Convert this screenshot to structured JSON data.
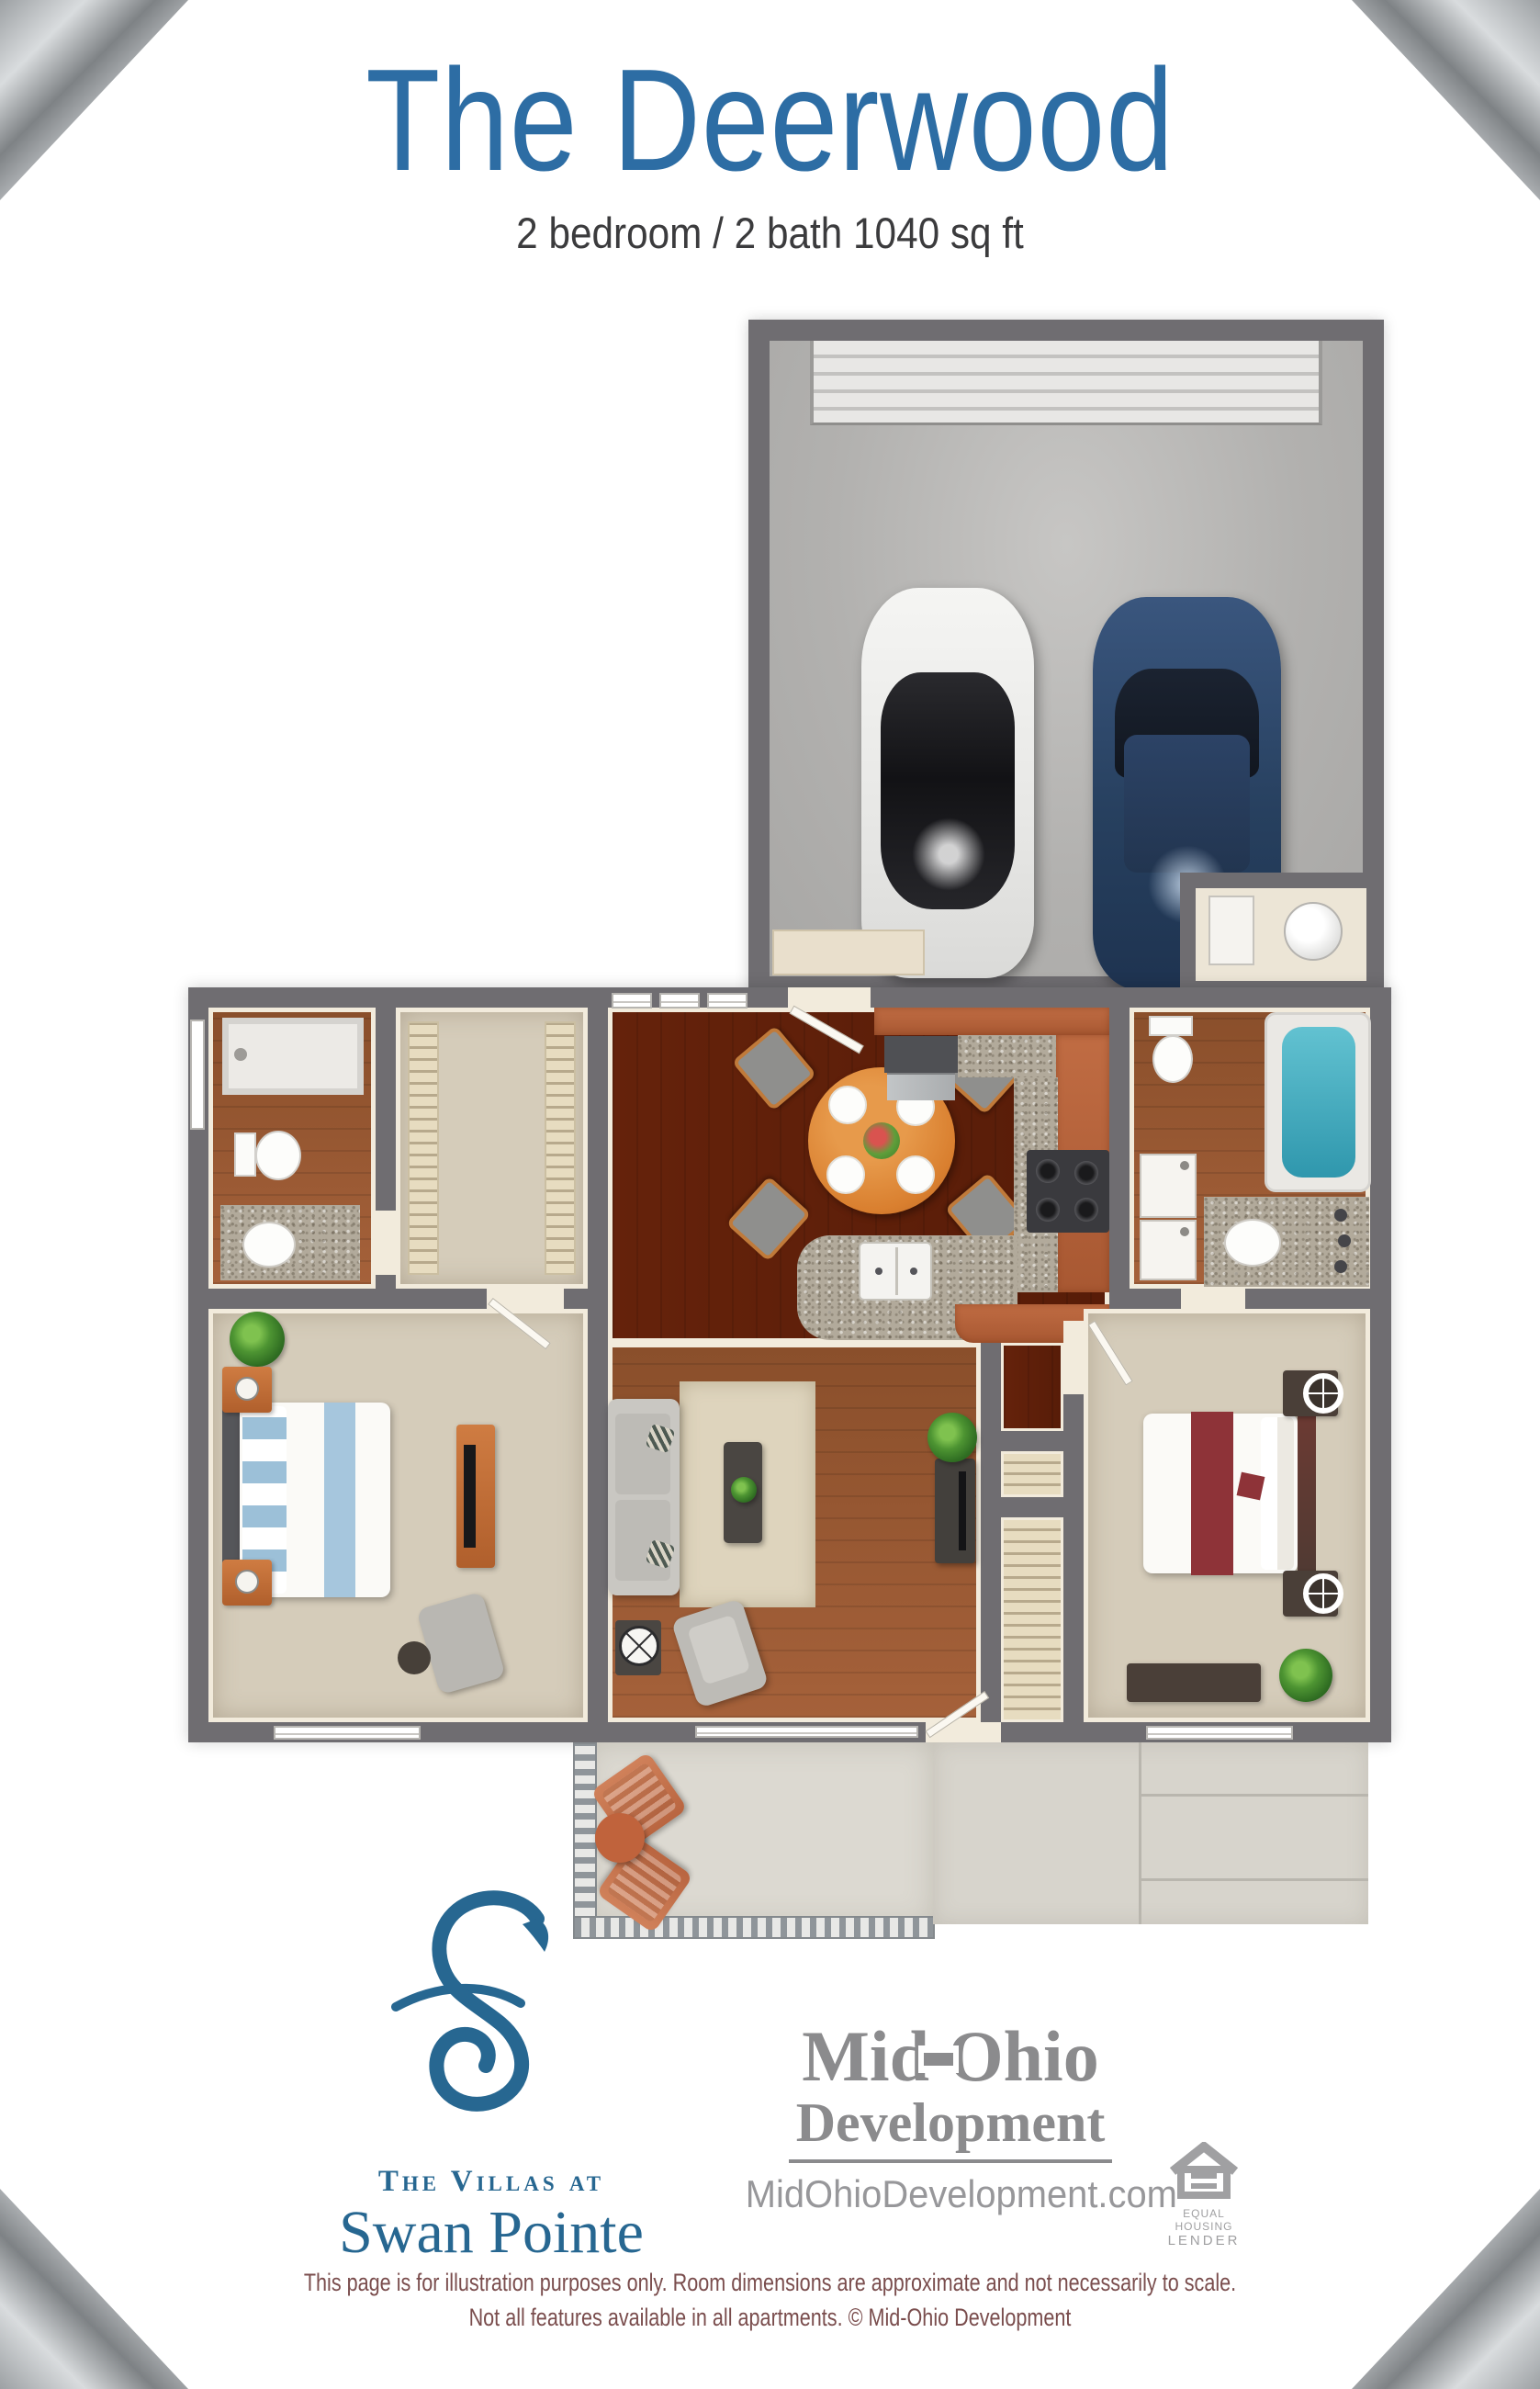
{
  "page": {
    "title": "The Deerwood",
    "subtitle": "2 bedroom / 2 bath 1040 sq ft"
  },
  "branding": {
    "community": {
      "prefix": "The Villas at",
      "name": "Swan Pointe"
    },
    "developer": {
      "name_part1": "Mid",
      "name_part2": "Ohio",
      "line2": "Development",
      "website": "MidOhioDevelopment.com"
    },
    "equal_housing": {
      "line1": "EQUAL HOUSING",
      "line2": "LENDER"
    }
  },
  "disclaimer": {
    "line1": "This page is for illustration purposes only.  Room dimensions are approximate and not necessarily to scale.",
    "line2": "Not all features available in all apartments. © Mid-Ohio Development"
  },
  "colors": {
    "title_blue": "#2d6da4",
    "logo_blue": "#276791",
    "developer_gray": "#8b8b8d",
    "disclaimer_maroon": "#7a4d4d",
    "wall_gray": "#6f6d71",
    "wood_floor": "#9c5a31",
    "carpet": "#d5ccba",
    "cabinet_orange": "#b96740",
    "tub_teal": "#45b0c4"
  },
  "floorplan": {
    "rooms": [
      "garage",
      "kitchen",
      "dining area",
      "living room",
      "bedroom",
      "bedroom",
      "bathroom",
      "bathroom",
      "walk-in closet",
      "utility room",
      "patio"
    ]
  }
}
